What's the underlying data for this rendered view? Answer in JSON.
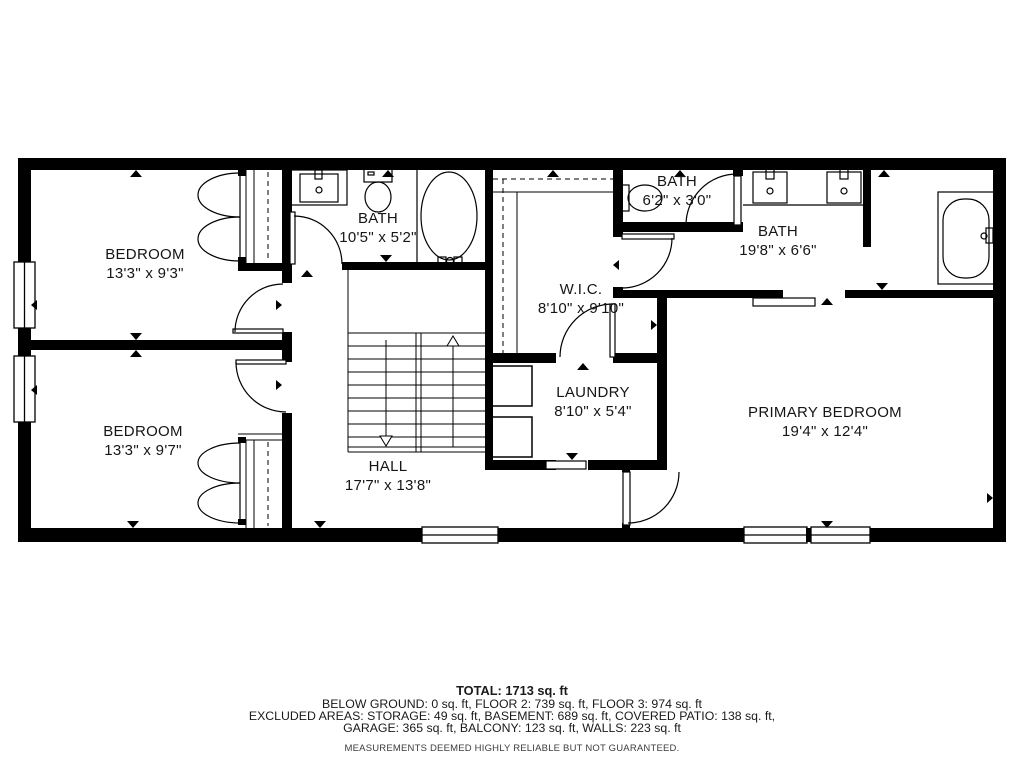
{
  "floor_plan": {
    "rooms": [
      {
        "id": "bedroom-1",
        "label": "BEDROOM",
        "dims": "13'3\" x 9'3\""
      },
      {
        "id": "bath-1",
        "label": "BATH",
        "dims": "10'5\" x 5'2\""
      },
      {
        "id": "wic",
        "label": "W.I.C.",
        "dims": "8'10\" x 9'10\""
      },
      {
        "id": "bath-2-small",
        "label": "BATH",
        "dims": "6'2\" x 3'0\""
      },
      {
        "id": "bath-3-primary",
        "label": "BATH",
        "dims": "19'8\" x 6'6\""
      },
      {
        "id": "bedroom-2",
        "label": "BEDROOM",
        "dims": "13'3\" x 9'7\""
      },
      {
        "id": "laundry",
        "label": "LAUNDRY",
        "dims": "8'10\" x 5'4\""
      },
      {
        "id": "hall",
        "label": "HALL",
        "dims": "17'7\" x 13'8\""
      },
      {
        "id": "primary-bedroom",
        "label": "PRIMARY BEDROOM",
        "dims": "19'4\" x 12'4\""
      }
    ]
  },
  "footer": {
    "total": "TOTAL: 1713 sq. ft",
    "line2": "BELOW GROUND: 0 sq. ft, FLOOR 2: 739 sq. ft, FLOOR 3: 974 sq. ft",
    "line3": "EXCLUDED AREAS: STORAGE: 49 sq. ft, BASEMENT: 689 sq. ft, COVERED PATIO: 138 sq. ft,",
    "line4": "GARAGE: 365 sq. ft, BALCONY: 123 sq. ft, WALLS: 223 sq. ft",
    "disclaimer": "MEASUREMENTS DEEMED HIGHLY RELIABLE BUT NOT GUARANTEED."
  },
  "colors": {
    "wall": "#000000",
    "background": "#ffffff",
    "line": "#000000",
    "disclaimer_text": "#3d3d3d"
  }
}
